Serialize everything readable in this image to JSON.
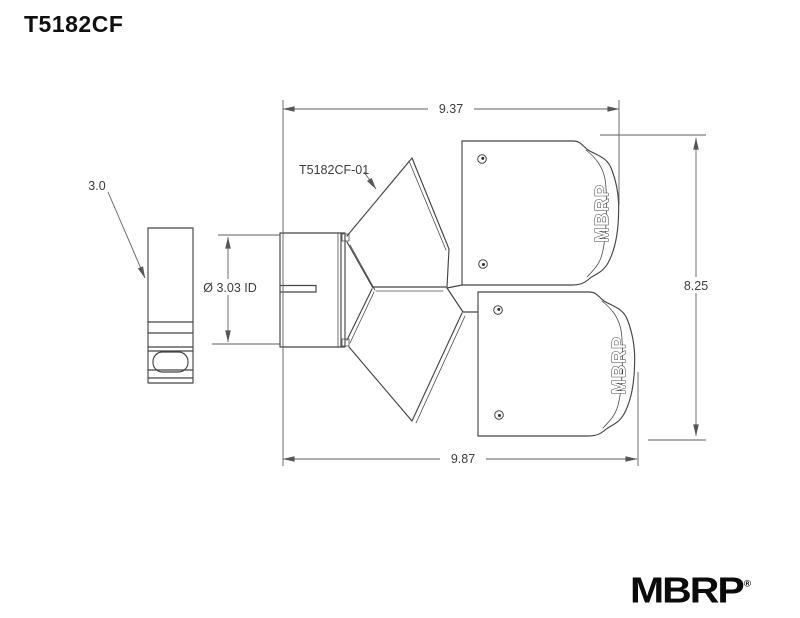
{
  "title": "T5182CF",
  "drawing": {
    "part_label": "T5182CF-01",
    "dims": {
      "top": "9.37",
      "bottom": "9.87",
      "right": "8.25",
      "inlet": "Ø 3.03 ID",
      "tube": "3.0"
    },
    "tip_brand": "MBRP",
    "colors": {
      "line": "#454545",
      "dimension": "#5f5f5f",
      "text": "#3d3d3d",
      "background": "#ffffff"
    }
  },
  "logo": {
    "brand": "MBRP",
    "reg": "®"
  }
}
